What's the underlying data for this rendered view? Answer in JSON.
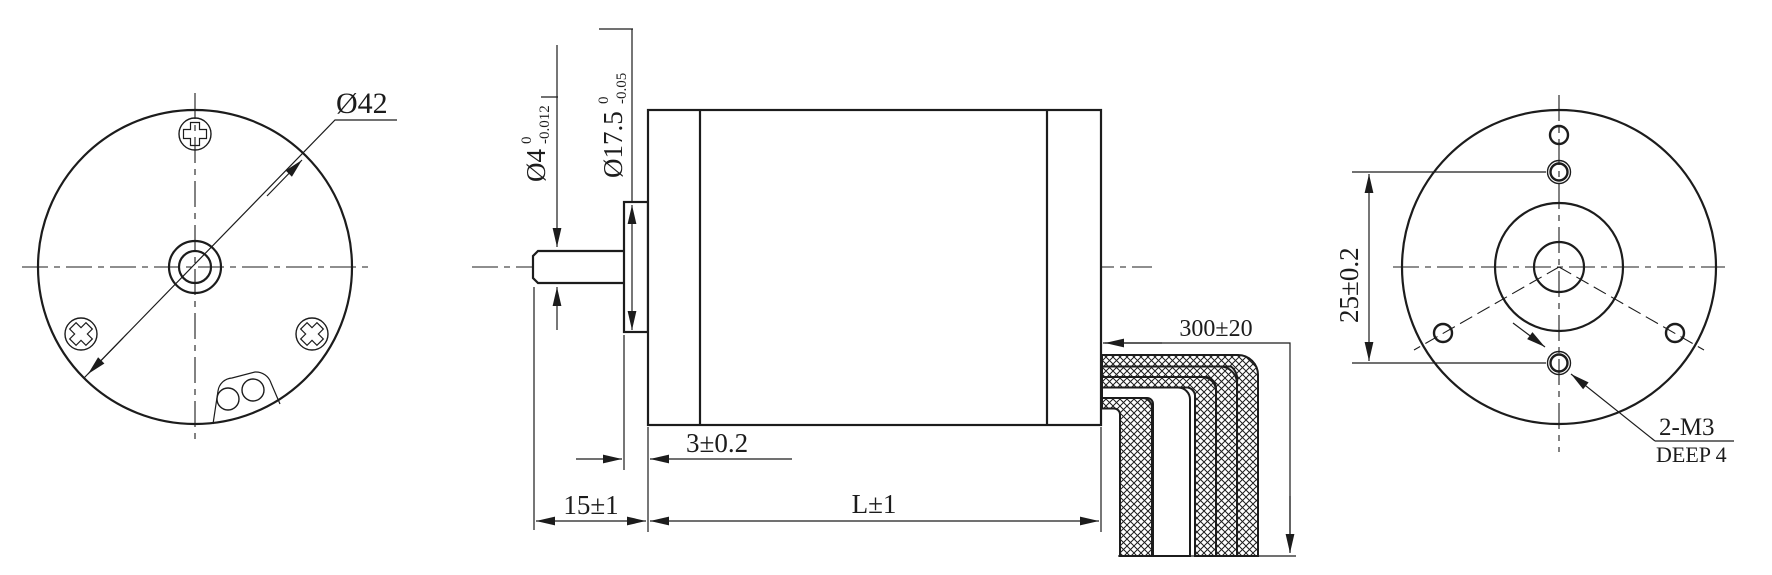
{
  "drawing": {
    "type": "engineering-drawing",
    "subject": "42mm round brushless motor outline drawing, three views"
  },
  "colors": {
    "line": "#1c1c1c",
    "background": "#ffffff"
  },
  "front_view": {
    "diameter_label": "Ø42"
  },
  "side_view": {
    "shaft_dia": "Ø4",
    "shaft_dia_tol_upper": "0",
    "shaft_dia_tol_lower": "-0.012",
    "boss_dia": "Ø17.5",
    "boss_dia_tol_upper": "0",
    "boss_dia_tol_lower": "-0.05",
    "boss_length": "3±0.2",
    "shaft_length": "15±1",
    "body_length": "L±1",
    "cable_length": "300±20"
  },
  "rear_view": {
    "hole_spacing": "25±0.2",
    "thread_note": "2-M3",
    "thread_depth": "DEEP 4"
  }
}
